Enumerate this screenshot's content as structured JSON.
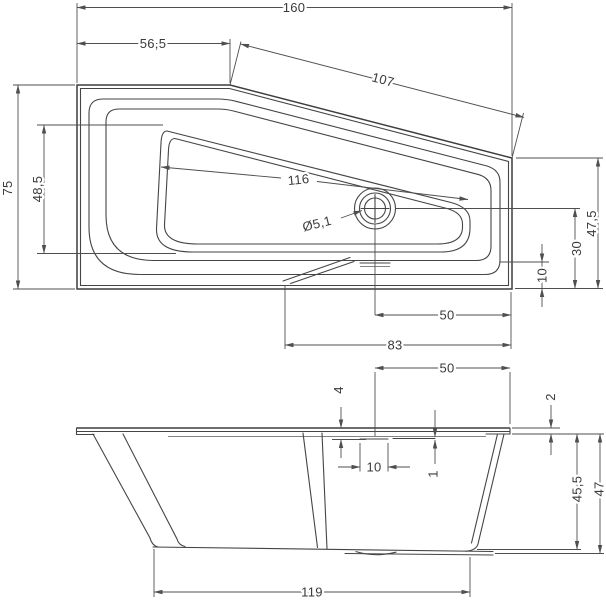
{
  "colors": {
    "line": "#454545",
    "dimension_line": "#4f4f4f",
    "text": "#3a3a3a",
    "background": "#ffffff"
  },
  "plan": {
    "dim_overall_length": "160",
    "dim_top_edge_straight": "56,5",
    "dim_top_edge_slanted": "107",
    "dim_overall_width": "75",
    "dim_basin_width_left": "48,5",
    "dim_basin_length": "116",
    "dim_drain_diameter": "Ø5,1",
    "dim_drain_center_to_right_edge": "50",
    "dim_basin_end_to_right_edge": "83",
    "dim_right_end_width_total": "47,5",
    "dim_right_end_drain_offset": "30",
    "dim_right_end_rim": "10"
  },
  "side": {
    "dim_drain_center_to_right_edge": "50",
    "dim_rim_to_recess": "4",
    "dim_rim_lip_thickness": "2",
    "dim_recess_width": "10",
    "dim_recess_step": "1",
    "dim_height_inner": "45,5",
    "dim_height_overall": "47",
    "dim_base_length": "119"
  }
}
